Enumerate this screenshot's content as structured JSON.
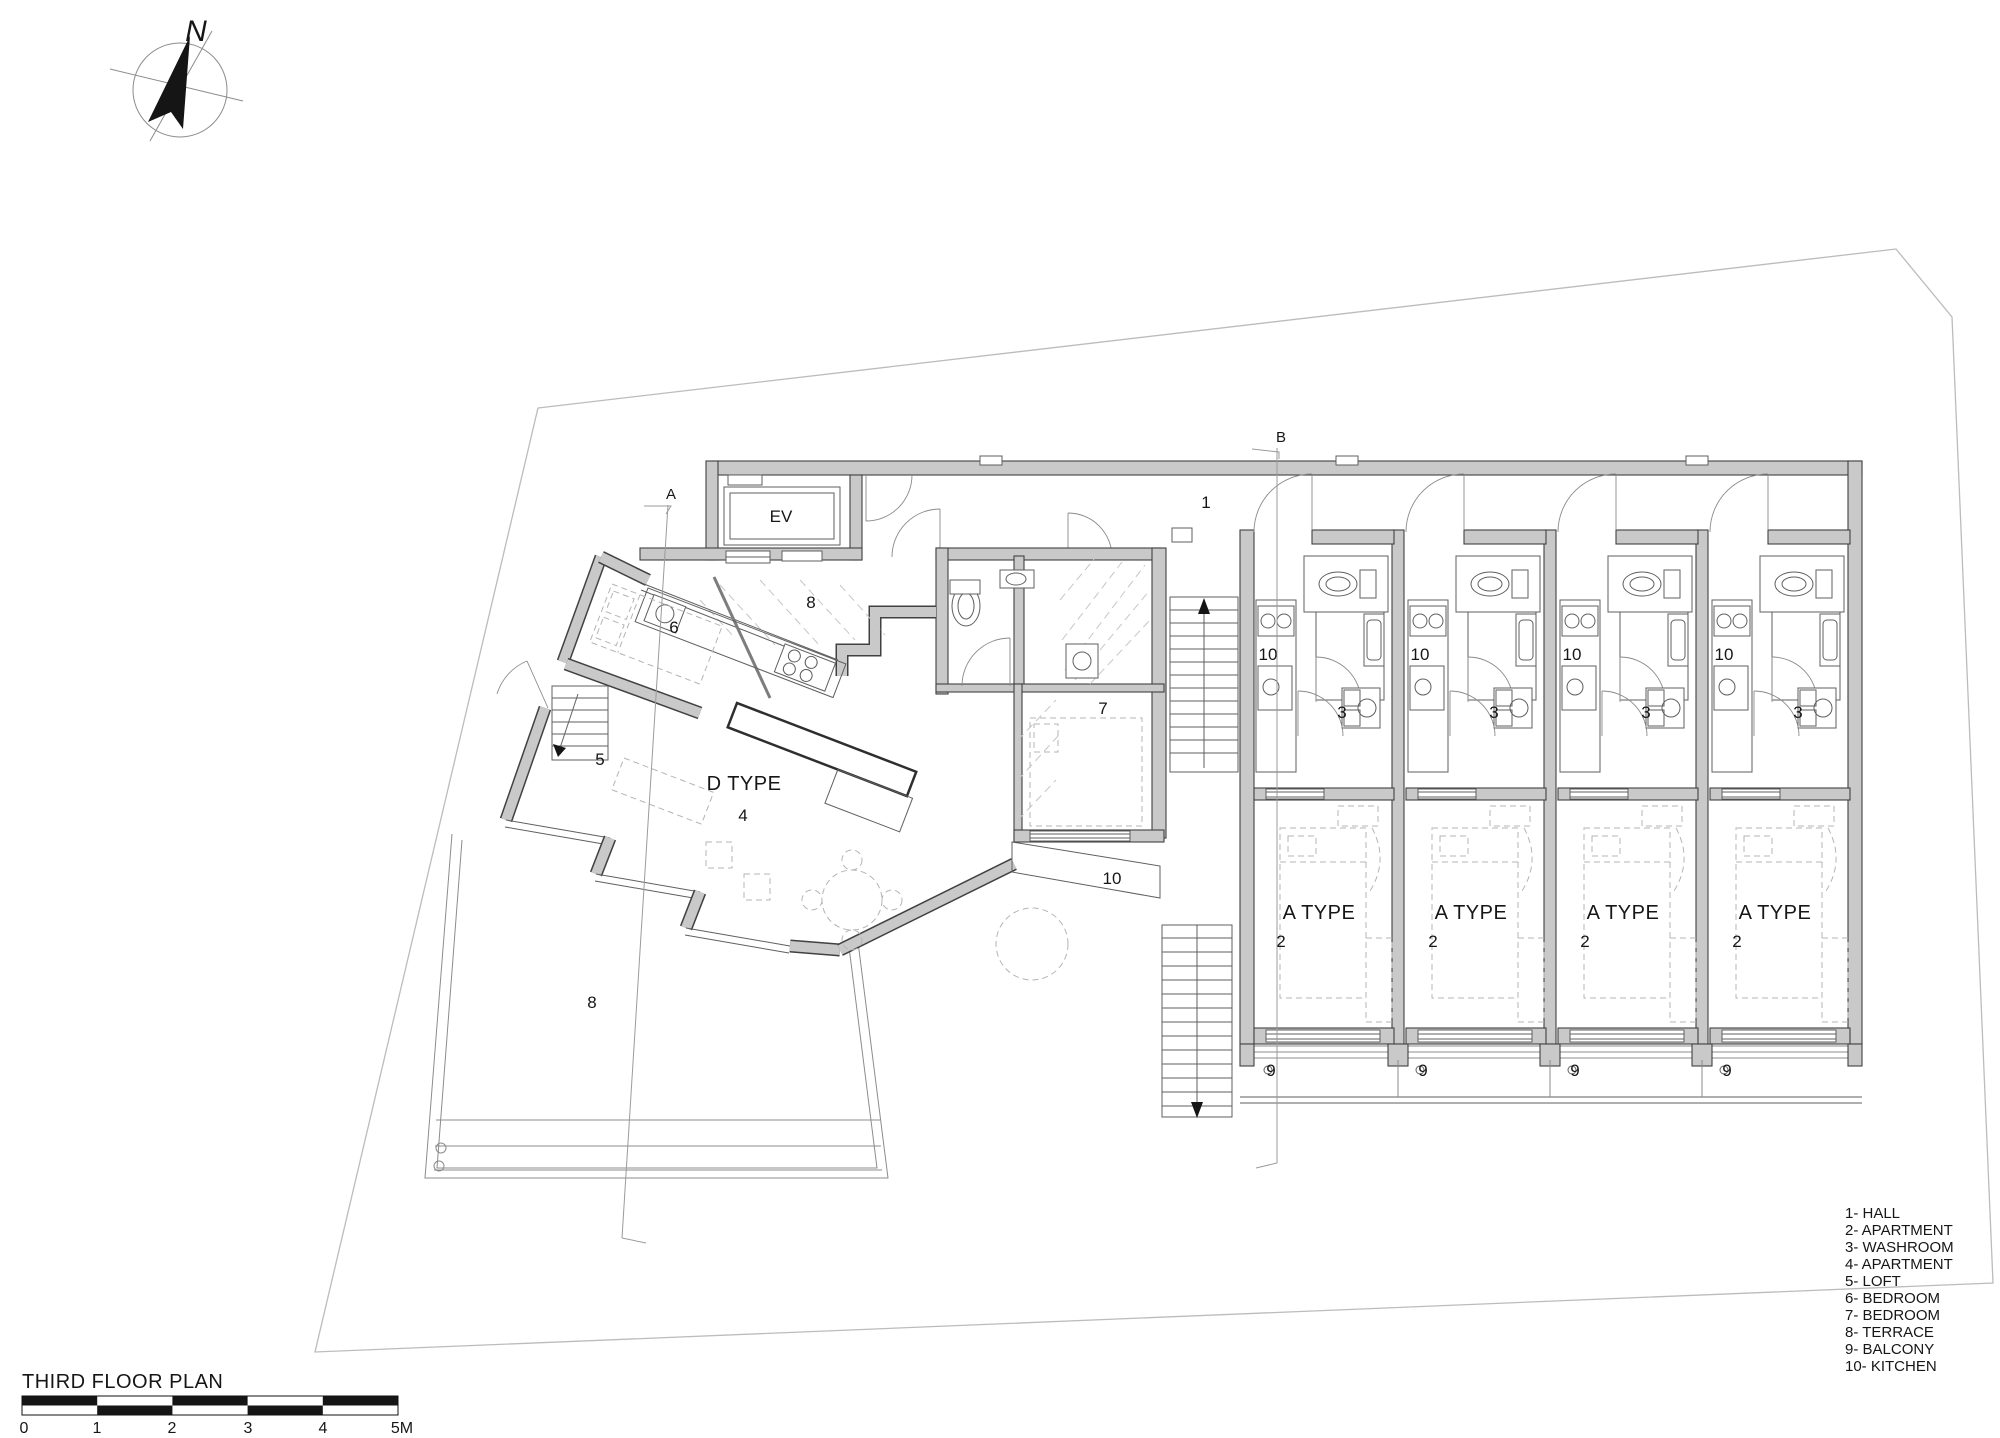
{
  "title": "THIRD FLOOR PLAN",
  "north": {
    "label": "N"
  },
  "sections": {
    "a": "A",
    "b": "B"
  },
  "scale_bar": {
    "labels": [
      "0",
      "1",
      "2",
      "3",
      "4",
      "5M"
    ]
  },
  "legend": {
    "items": [
      "1- HALL",
      "2- APARTMENT",
      "3- WASHROOM",
      "4- APARTMENT",
      "5- LOFT",
      "6- BEDROOM",
      "7- BEDROOM",
      "8- TERRACE",
      "9- BALCONY",
      "10- KITCHEN"
    ]
  },
  "rooms": {
    "hall": "1",
    "elevator": "EV",
    "courtyard_terrace": "8",
    "bedroom6": "6",
    "loft": "5",
    "d_type": "D TYPE",
    "apartment4": "4",
    "bedroom7": "7",
    "kitchen_strip": "10",
    "main_terrace": "8"
  },
  "a_units": [
    {
      "type": "A TYPE",
      "apartment": "2",
      "washroom": "3",
      "kitchen": "10",
      "balcony": "9"
    },
    {
      "type": "A TYPE",
      "apartment": "2",
      "washroom": "3",
      "kitchen": "10",
      "balcony": "9"
    },
    {
      "type": "A TYPE",
      "apartment": "2",
      "washroom": "3",
      "kitchen": "10",
      "balcony": "9"
    },
    {
      "type": "A TYPE",
      "apartment": "2",
      "washroom": "3",
      "kitchen": "10",
      "balcony": "9"
    }
  ],
  "colors": {
    "wall_fill": "#c9c9c9",
    "wall_stroke": "#414141",
    "thin_line": "#5f5f5f",
    "dashed_furniture": "#b4b4b4",
    "site_boundary": "#bcbcbc",
    "ink": "#161616"
  }
}
